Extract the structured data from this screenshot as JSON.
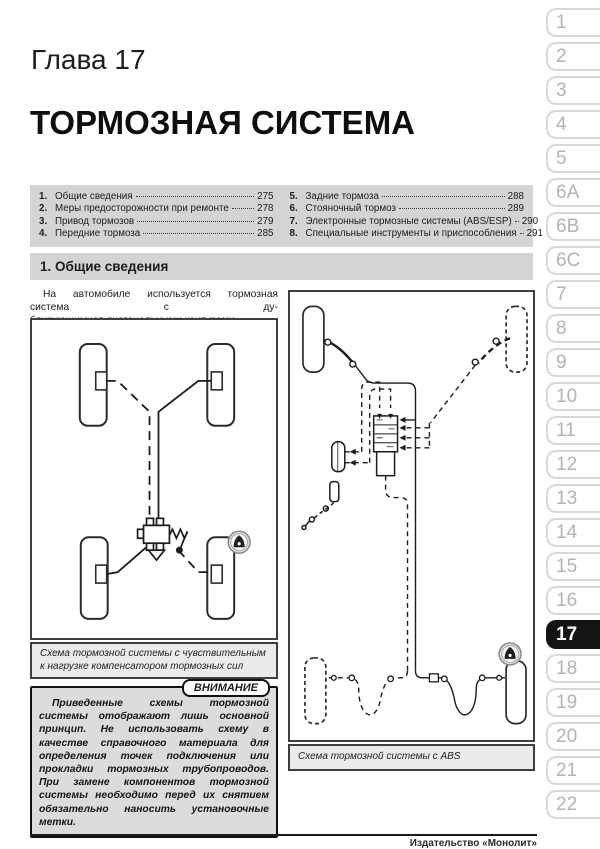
{
  "page": {
    "chapter": "Глава 17",
    "title": "ТОРМОЗНАЯ СИСТЕМА",
    "footer": "Издательство «Монолит»"
  },
  "toc": {
    "left": [
      {
        "num": "1.",
        "label": "Общие сведения",
        "page": "275"
      },
      {
        "num": "2.",
        "label": "Меры предосторожности при ремонте",
        "page": "278"
      },
      {
        "num": "3.",
        "label": "Привод тормозов",
        "page": "279"
      },
      {
        "num": "4.",
        "label": "Передние тормоза",
        "page": "285"
      }
    ],
    "right": [
      {
        "num": "5.",
        "label": "Задние тормоза",
        "page": "288"
      },
      {
        "num": "6.",
        "label": "Стояночный тормоз",
        "page": "289"
      },
      {
        "num": "7.",
        "label": "Электронные тормозные системы (ABS/ESP)",
        "page": "290"
      },
      {
        "num": "8.",
        "label": "Специальные инструменты и приспособления",
        "page": "291"
      }
    ]
  },
  "section": {
    "heading": "1. Общие сведения",
    "intro_line1": "На автомобиле используется тормозная система с ду-",
    "intro_line2": "блирующимися диагональными контурами."
  },
  "figures": {
    "fig1_caption": "Схема тормозной системы с чувствительным к нагрузке компенсатором тормозных сил",
    "fig2_caption": "Схема тормозной системы с ABS"
  },
  "warning": {
    "label": "ВНИМАНИЕ",
    "text": "Приведенные схемы тормозной системы отображают лишь основной принцип. Не использовать схему в качестве справочного материала для определения точек подключения или прокладки тормозных трубопроводов. При замене компонентов тормозной системы необходимо перед их снятием обязательно наносить установочные метки."
  },
  "sidebar": {
    "tabs": [
      "1",
      "2",
      "3",
      "4",
      "5",
      "6A",
      "6B",
      "6C",
      "7",
      "8",
      "9",
      "10",
      "11",
      "12",
      "13",
      "14",
      "15",
      "16",
      "17",
      "18",
      "19",
      "20",
      "21",
      "22"
    ],
    "active": "17"
  },
  "colors": {
    "bar_background": "#d4d4d4",
    "warning_background": "#dcdcdc",
    "active_tab_background": "#141414",
    "tab_text": "#b3b3b3"
  }
}
